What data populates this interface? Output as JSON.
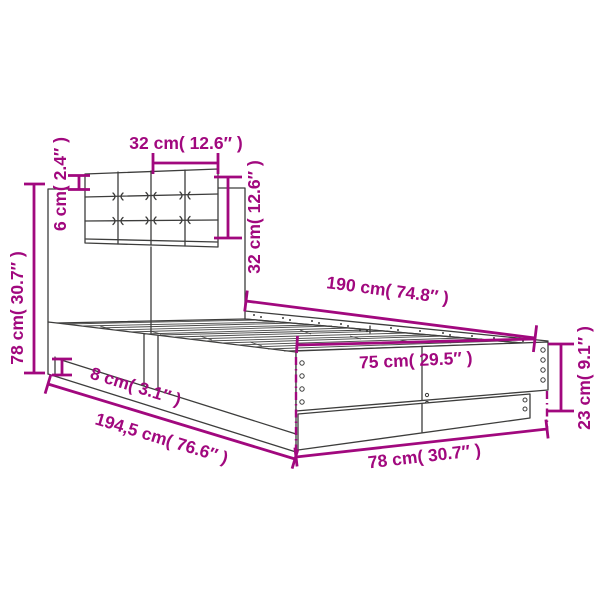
{
  "title": "Bed frame with headboard dimension diagram",
  "colors": {
    "dimension_annotation": "#A1087E",
    "line_art": "#3D3D3C",
    "background": "#FFFFFF"
  },
  "dims": [
    {
      "id": "headboard-cushion-width",
      "label": "32 cm( 12.6″ )"
    },
    {
      "id": "cushion-top-offset",
      "label": "6 cm( 2.4″ )"
    },
    {
      "id": "headboard-height",
      "label": "78 cm( 30.7″ )"
    },
    {
      "id": "headboard-cushion-height",
      "label": "32 cm( 12.6″ )"
    },
    {
      "id": "bed-length",
      "label": "190 cm( 74.8″ )"
    },
    {
      "id": "bed-inner-width",
      "label": "75 cm( 29.5″ )"
    },
    {
      "id": "frame-height",
      "label": "23 cm( 9.1″ )"
    },
    {
      "id": "plinth-height",
      "label": "8 cm( 3.1″ )"
    },
    {
      "id": "total-length",
      "label": "194,5 cm( 76.6″ )"
    },
    {
      "id": "frame-outer-width",
      "label": "78 cm( 30.7″ )"
    }
  ]
}
